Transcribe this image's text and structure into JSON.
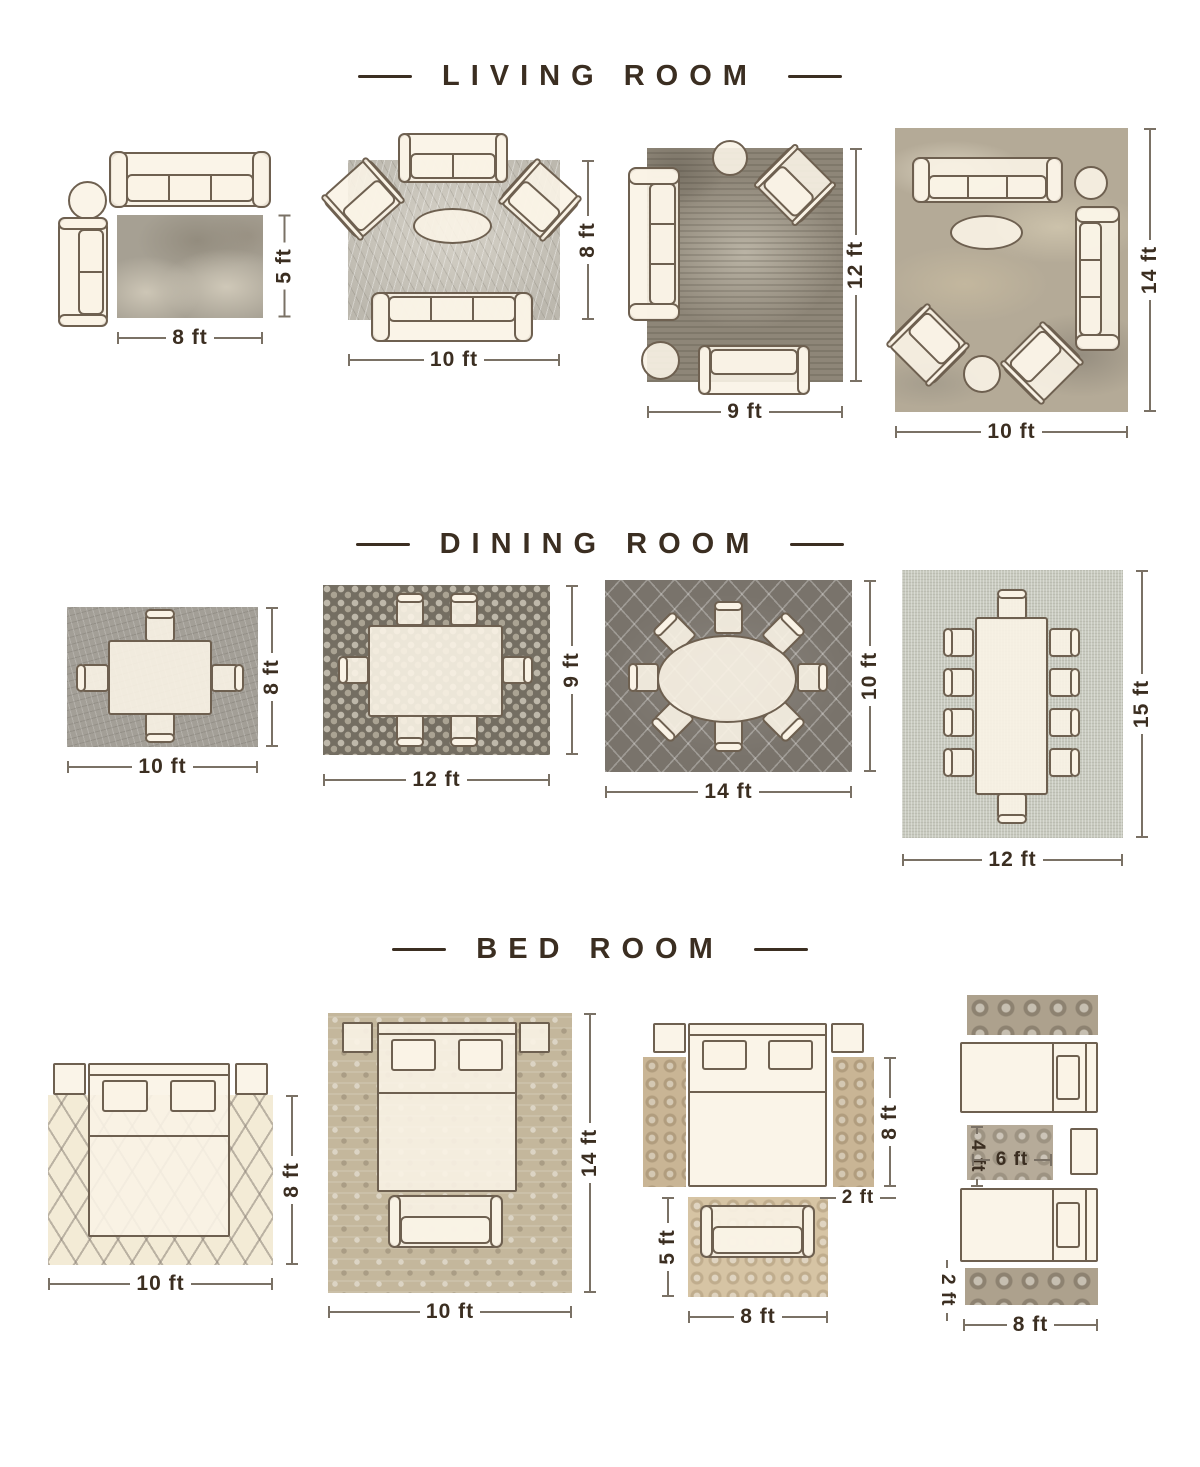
{
  "colors": {
    "accent_text": "#3b2e21",
    "furniture_outline": "#6e6050",
    "furniture_fill": "#faf3e6",
    "dimension_line": "#7a7165"
  },
  "sections": {
    "living_room": {
      "title": "LIVING ROOM",
      "layouts": [
        {
          "name": "sofa-loveseat-corner-rug",
          "width_label": "8 ft",
          "height_label": "5 ft"
        },
        {
          "name": "sofa-two-armchairs-rug",
          "width_label": "10 ft",
          "height_label": "8 ft"
        },
        {
          "name": "sofa-loveseat-armchair-rug",
          "width_label": "9 ft",
          "height_label": "12 ft"
        },
        {
          "name": "two-sofas-two-armchairs-rug",
          "width_label": "10 ft",
          "height_label": "14 ft"
        }
      ]
    },
    "dining_room": {
      "title": "DINING ROOM",
      "layouts": [
        {
          "name": "table-four-chairs-rug",
          "width_label": "10 ft",
          "height_label": "8 ft"
        },
        {
          "name": "table-six-chairs-rug",
          "width_label": "12 ft",
          "height_label": "9 ft"
        },
        {
          "name": "oval-table-eight-chairs-rug",
          "width_label": "14 ft",
          "height_label": "10 ft"
        },
        {
          "name": "table-ten-chairs-rug",
          "width_label": "12 ft",
          "height_label": "15 ft"
        }
      ]
    },
    "bed_room": {
      "title": "BED ROOM",
      "layouts": [
        {
          "name": "bed-on-area-rug",
          "width_label": "10 ft",
          "height_label": "8 ft"
        },
        {
          "name": "bed-bench-on-area-rug",
          "width_label": "10 ft",
          "height_label": "14 ft"
        },
        {
          "name": "bed-side-runners-foot-rug",
          "bed_height_label": "8 ft",
          "runner_width_label": "2 ft",
          "foot_rug_height_label": "5 ft",
          "foot_rug_width_label": "8 ft"
        },
        {
          "name": "twin-beds-runners-accent-rug",
          "accent_rug_height_label": "4 ft",
          "accent_rug_width_label": "6 ft",
          "runner_width_label": "2 ft",
          "width_label": "8 ft"
        }
      ]
    }
  }
}
